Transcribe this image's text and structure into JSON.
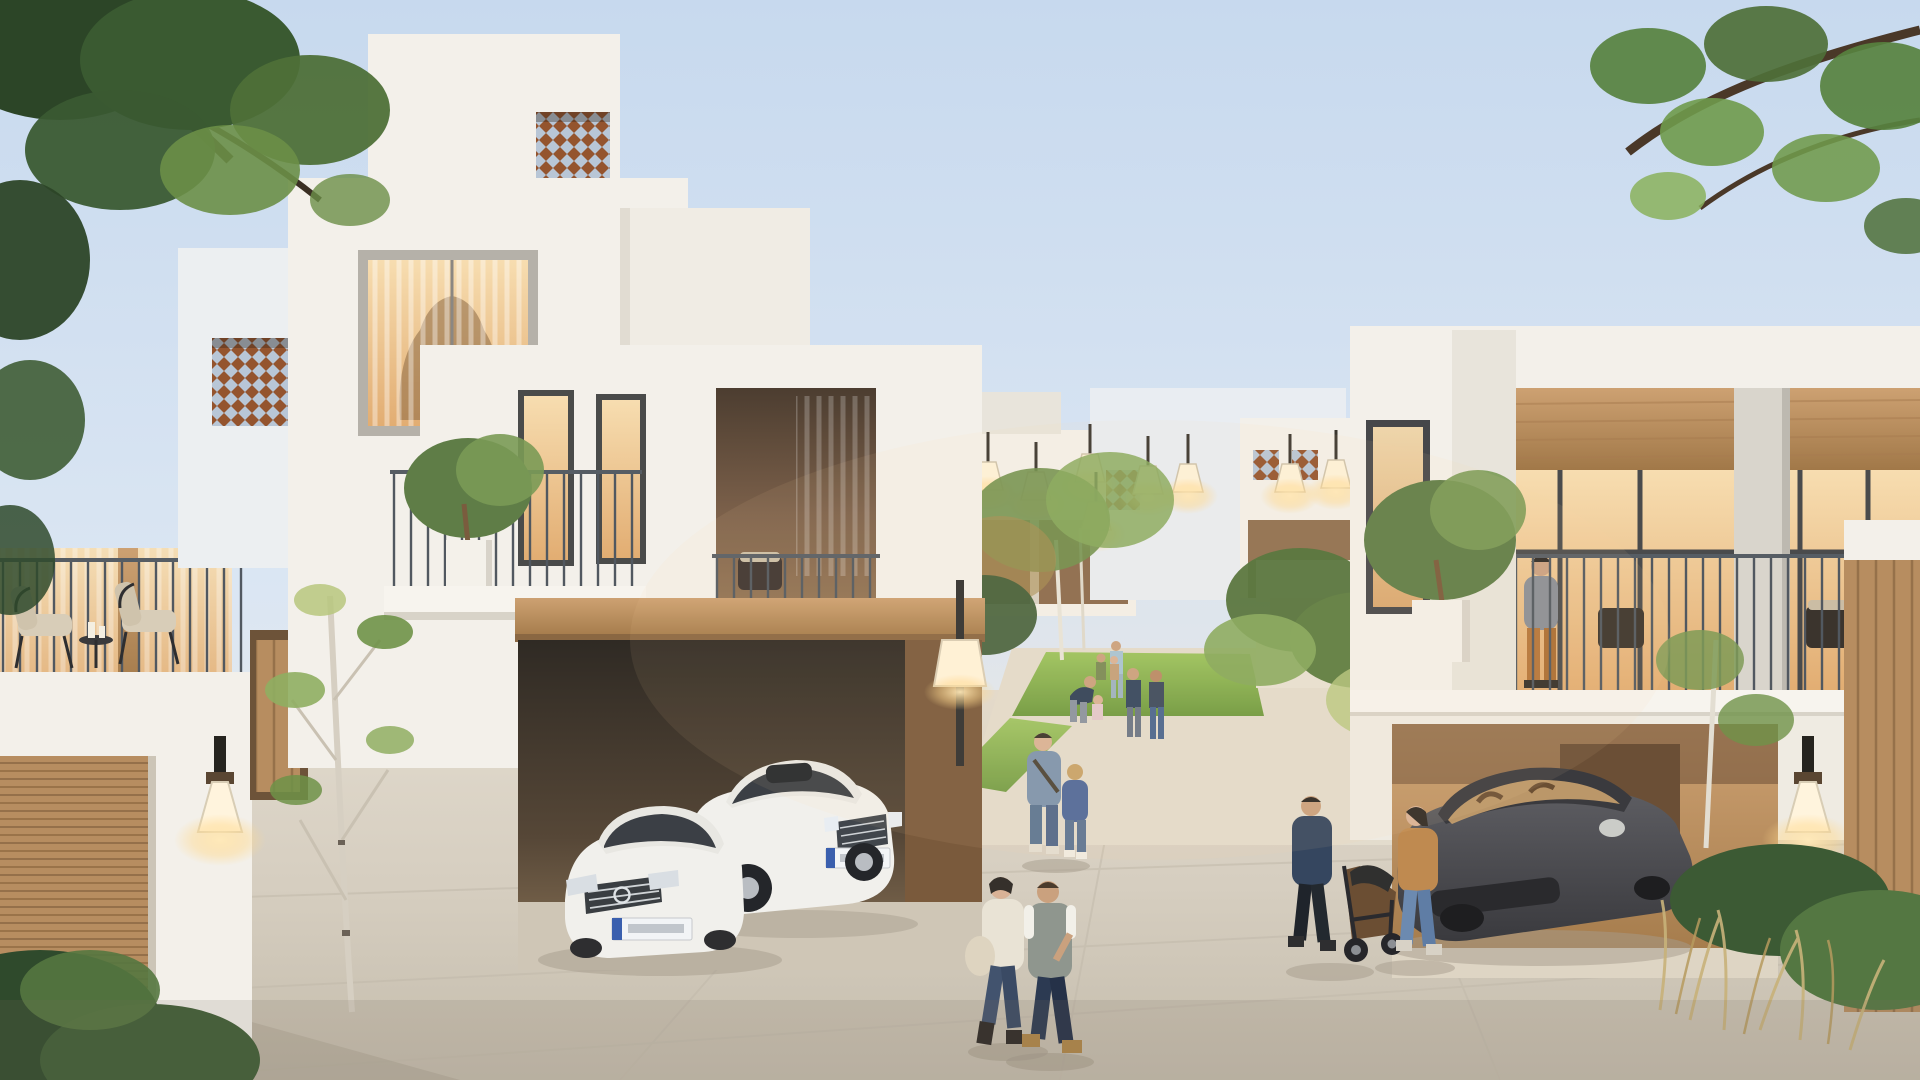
{
  "meta": {
    "type": "architectural-render",
    "description": "Dusk 3D rendering of a modern white townhouse community: villas with mashrabiya lattice screens and timber loggias, open garages with parked cars, a shared courtyard lawn with families, residents strolling on stone paving, warm lanterns glowing, framed by green tree branches",
    "time_of_day": "dusk"
  },
  "palette": {
    "sky_top": "#c7d9ee",
    "sky_horizon": "#f1ead9",
    "wall_white": "#f3f0ea",
    "wall_shadow": "#e8e4db",
    "wood": "#c0956a",
    "wood_dark": "#9a7349",
    "lattice_wood": "#94542e",
    "lattice_sky": "#bcd3e8",
    "lawn_light": "#9cc45e",
    "lawn_dark": "#6f9a40",
    "foliage_dark": "#2c4527",
    "foliage_mid": "#4e7038",
    "foliage_light": "#8fae62",
    "pavement": "#d6cec0",
    "lamp_glow": "#ffdf9e",
    "railing": "#515860",
    "car_white": "#f1f0ec",
    "car_grey": "#4b4b4f",
    "glass_warm": "#f0c98e"
  },
  "scene": {
    "sky": {
      "label": "Pale blue dusk sky fading to a warm horizon"
    },
    "tree_frame": {
      "label": "Dark green tree foliage framing the top-left corner and leafy branches entering from the top-right"
    },
    "left_villa": {
      "label": "Three-storey white stucco villa with two mashrabiya lattice screens, a large curtained picture window, balcony with two chairs and bistro table, wooden garage door and a glowing wall sconce",
      "lattice_screens": 2,
      "balcony_furniture": "two black-frame chairs with beige cushions and a small round table"
    },
    "center_garage": {
      "label": "Open double garage with timber lintel and two white sedans parked inside",
      "vehicles": [
        {
          "type": "Mercedes-Benz sedan",
          "color": "white",
          "license_plate": "EU-style plate, blue band, text illegible"
        },
        {
          "type": "Lexus sedan",
          "color": "white",
          "license_plate": "EU-style plate, blue band, text illegible"
        }
      ]
    },
    "center_balcony": {
      "label": "Balcony with potted olive tree behind a thin metal railing, beside a recessed loggia with seating"
    },
    "right_villa": {
      "label": "Two-storey townhouse with timber-lined loggia glowing warmly, concrete pillar, balcony railing and driveway garage",
      "resident": "Man in grey t-shirt and tan trousers standing at the balcony railing",
      "vehicle": {
        "type": "Porsche Panamera",
        "color": "dark grey",
        "interior": "tan leather visible through windshield"
      }
    },
    "background_homes": {
      "label": "Cluster of white cubic courtyard houses with small lattice windows and glowing pendant lanterns",
      "lantern_count": 8
    },
    "courtyard": {
      "label": "Shared green courtyard lawn with terraced planters and birch trees",
      "people": [
        "Parent in dark top leaning toward a toddler in pink",
        "Two men standing and chatting on the lawn",
        "Woman in light blue with small children",
        "Children playing on the grass"
      ]
    },
    "walkway_people": [
      {
        "label": "Woman in cream jacket with shoulder bag and jeans walking beside a man in grey vest over white t-shirt"
      },
      {
        "label": "Couple pushing a dark stroller: man in navy hoodie, woman in camel jacket and blue jeans"
      },
      {
        "label": "Mother in denim jacket holding hands with a child in a blue jacket"
      }
    ],
    "lighting": {
      "wall_sconces": 3,
      "post_lamps": 1,
      "pendant_lanterns": 8
    },
    "flora": {
      "label": "Slender birch sapling by the left villa, shrubs and dry grasses by the right driveway, low bushes at bottom-left"
    },
    "ground": {
      "label": "Light stone-paved shared street in the foreground"
    }
  }
}
